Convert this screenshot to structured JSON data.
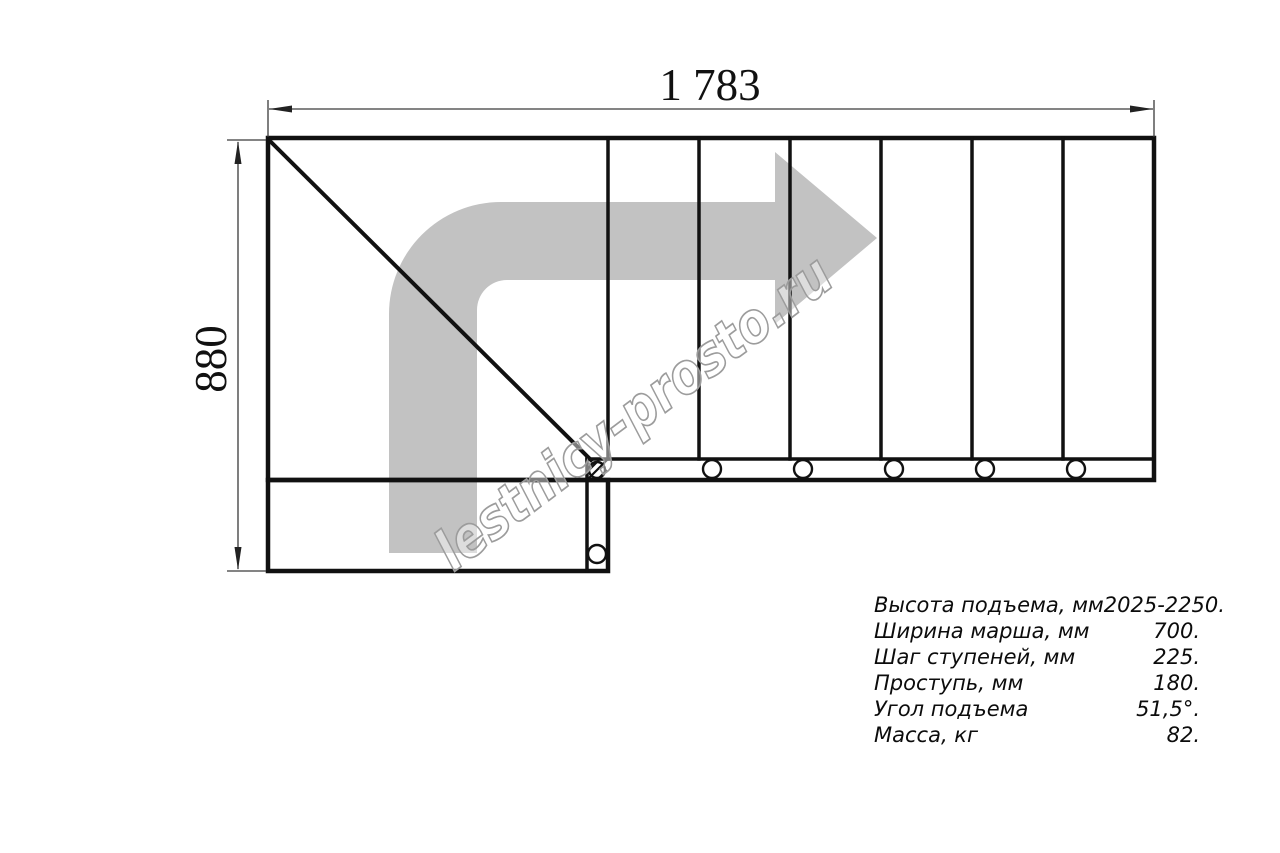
{
  "dimensions": {
    "width_label": "1 783",
    "height_label": "880"
  },
  "watermark": {
    "text": "lestnicy-prosto.ru"
  },
  "specs": {
    "rows": [
      {
        "label": "Высота подъема, мм",
        "value": "2025-2250."
      },
      {
        "label": "Ширина марша, мм",
        "value": "700."
      },
      {
        "label": "Шаг ступеней, мм",
        "value": "225."
      },
      {
        "label": "Проступь, мм",
        "value": "180."
      },
      {
        "label": "Угол подъема",
        "value": "51,5°."
      },
      {
        "label": "Масса, кг",
        "value": "82."
      }
    ]
  },
  "colors": {
    "line": "#111111",
    "dimension_line": "#3a3a3a",
    "arrow_fill": "#c2c2c2",
    "watermark_outline": "#9c9c9c",
    "background": "#ffffff"
  }
}
